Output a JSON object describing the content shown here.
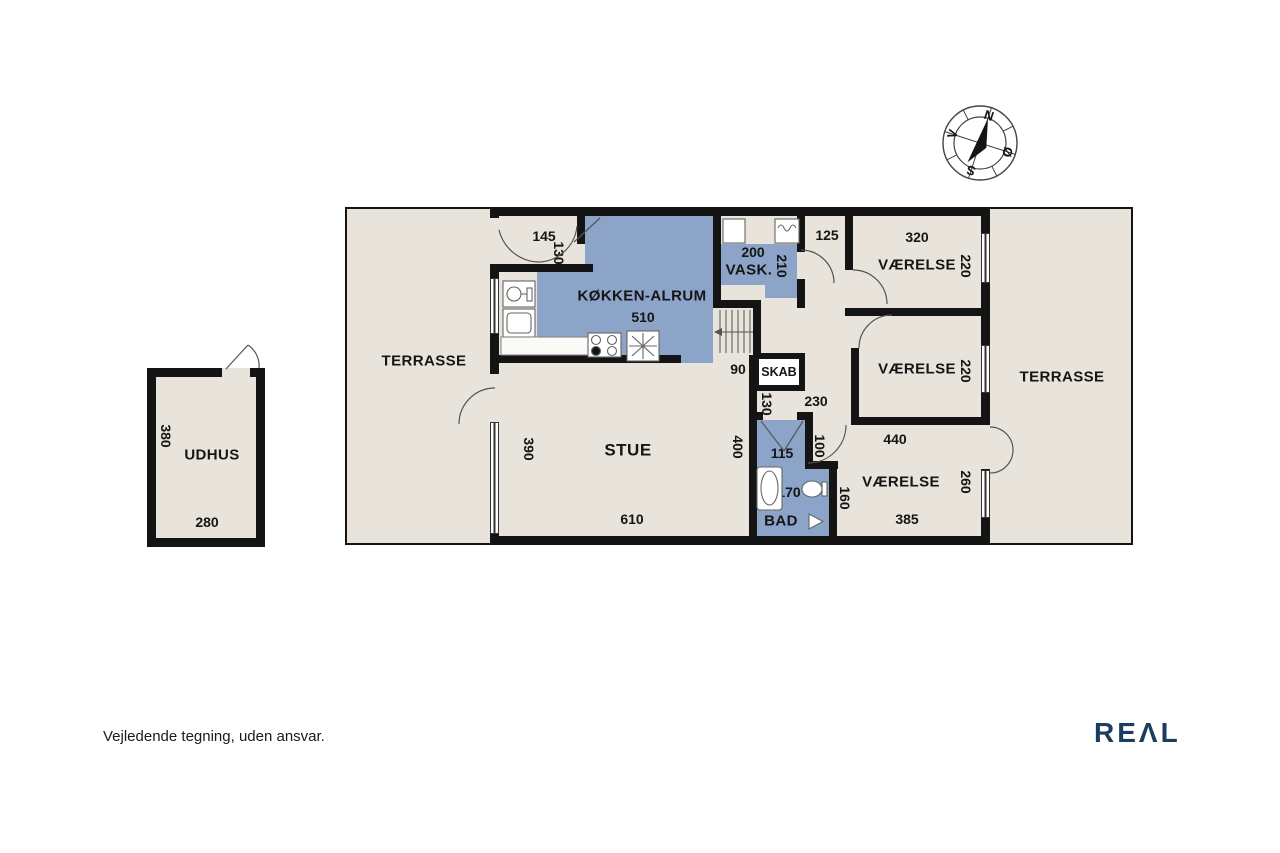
{
  "page": {
    "disclaimer": "Vejledende tegning, uden ansvar.",
    "brand": "REAL",
    "brand_display": "REΛL"
  },
  "colors": {
    "room_blue": "#8ca4c8",
    "floor": "#e8e4dc",
    "wall": "#141414",
    "brand_navy": "#1e3c5f"
  },
  "compass": {
    "north": "N",
    "south": "S",
    "west": "V",
    "east": "Ø"
  },
  "floorplan": {
    "terrasse_left": {
      "name": "TERRASSE"
    },
    "terrasse_right": {
      "name": "TERRASSE"
    },
    "entry": {
      "w": "145",
      "h": "130"
    },
    "kitchen": {
      "name": "KØKKEN-ALRUM",
      "w": "510"
    },
    "vask": {
      "name": "VASK.",
      "w": "200",
      "h": "210"
    },
    "hall": {
      "w": "125",
      "stair_w": "90",
      "corridor_h": "130",
      "w2": "230"
    },
    "skab": {
      "name": "SKAB"
    },
    "stue": {
      "name": "STUE",
      "h_left": "390",
      "h_right": "400",
      "w": "610"
    },
    "bad": {
      "name": "BAD",
      "w": "115",
      "inner_l": "170",
      "corridor_h": "100",
      "side_h": "160"
    },
    "vaerelse_top": {
      "name": "VÆRELSE",
      "w": "320",
      "h": "220"
    },
    "vaerelse_mid": {
      "name": "VÆRELSE",
      "h": "220"
    },
    "vaerelse_bottom": {
      "name": "VÆRELSE",
      "w_top": "440",
      "w_bottom": "385",
      "h_right": "260"
    },
    "udhus": {
      "name": "UDHUS",
      "w": "280",
      "h": "380"
    }
  }
}
